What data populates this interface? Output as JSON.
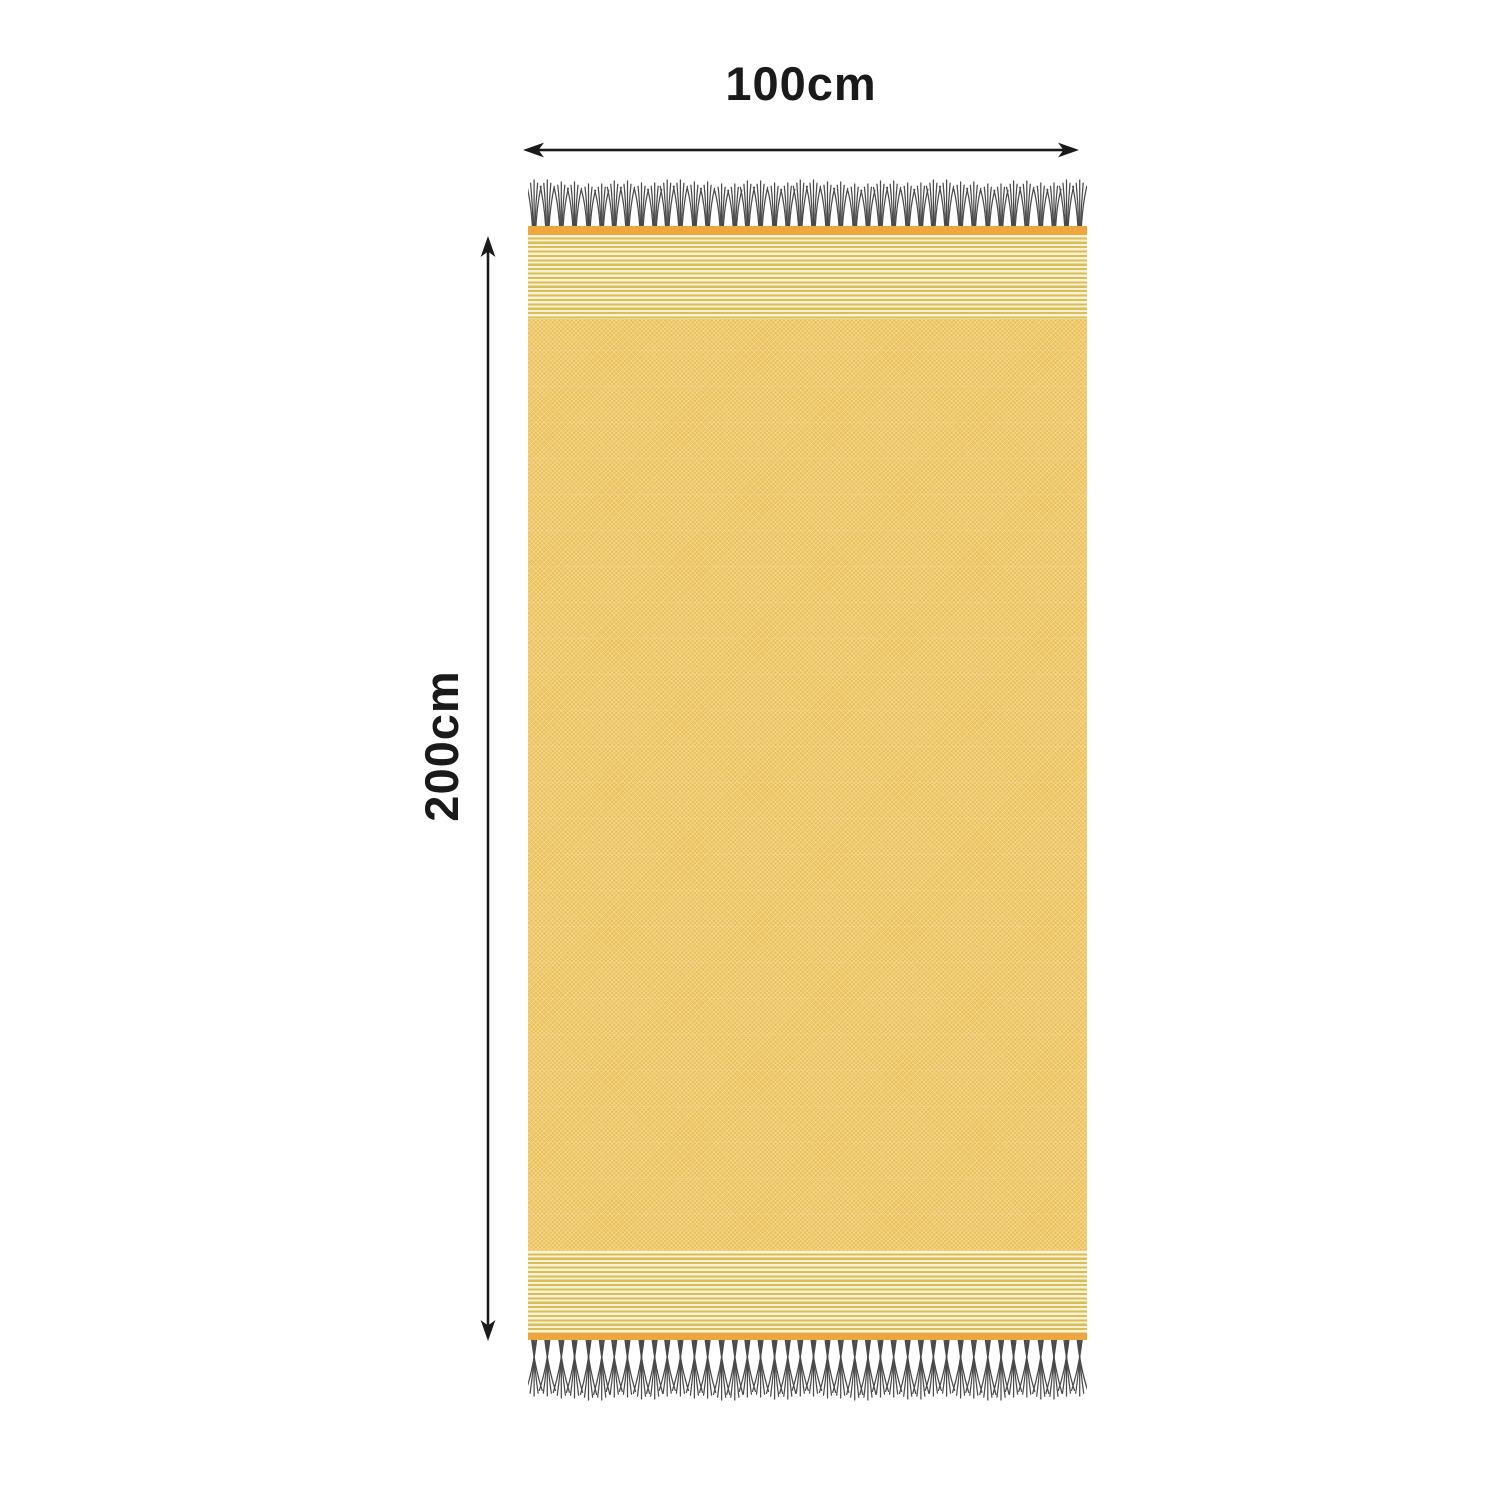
{
  "dimensions": {
    "width_label": "100cm",
    "height_label": "200cm"
  },
  "towel": {
    "description": "yellow fringed hammam beach towel shown flat",
    "colors": {
      "body": "#EBC05A",
      "body_speckle": "#F6DE9B",
      "band": "#EDA73E",
      "stripe_gold": "#D9BE55",
      "stripe_cream": "#F7F2D6",
      "fringe": "#4A4A4A"
    },
    "fringe": {
      "top_tassel_count": 21,
      "bottom_tassel_count": 21
    }
  },
  "annotation": {
    "ink": "#1A1A1A"
  }
}
